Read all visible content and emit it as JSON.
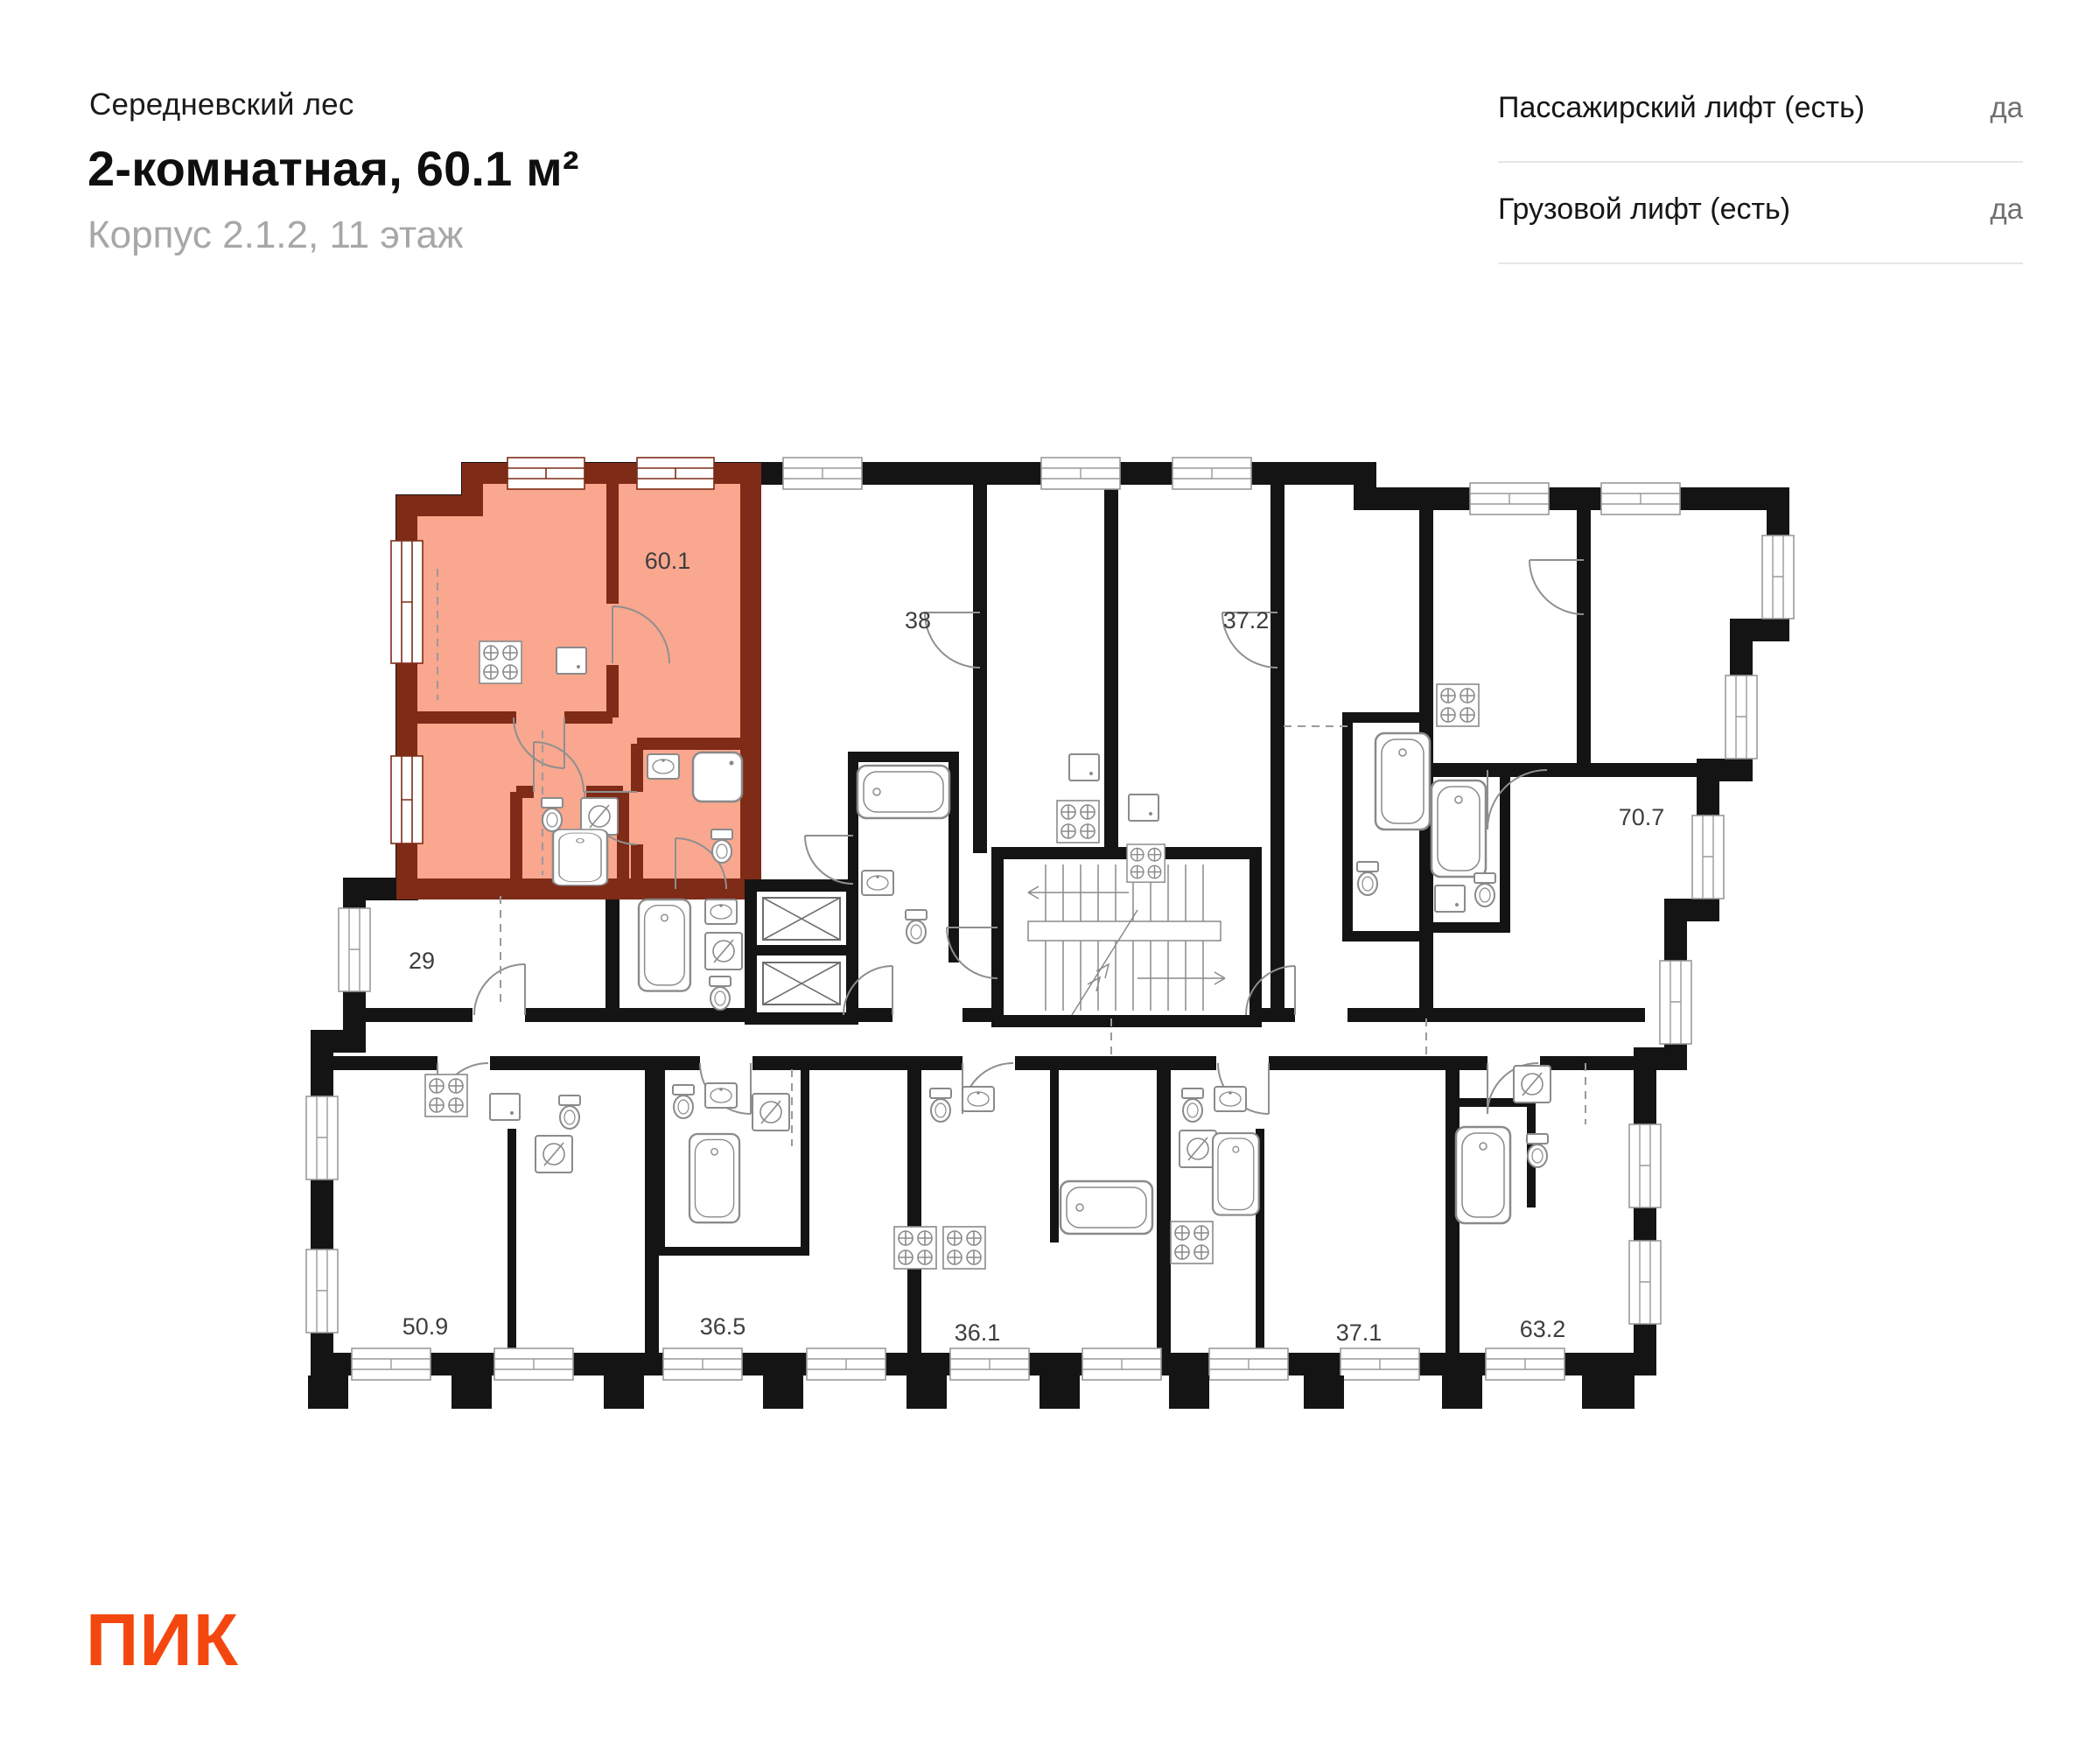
{
  "header": {
    "project": "Середневский лес",
    "title": "2-комнатная, 60.1 м²",
    "subtitle": "Корпус 2.1.2, 11 этаж"
  },
  "info_panel": {
    "rows": [
      {
        "label": "Пассажирский лифт (есть)",
        "value": "да"
      },
      {
        "label": "Грузовой лифт (есть)",
        "value": "да"
      }
    ]
  },
  "logo": {
    "text": "ПИК",
    "color": "#F4470F"
  },
  "floor_plan": {
    "highlighted_unit": {
      "area_label": "60.1",
      "fill": "#F9A78F",
      "wall_color": "#7E2B17"
    },
    "unit_labels": {
      "u38": "38",
      "u37_2": "37.2",
      "u70_7": "70.7",
      "u29": "29",
      "u50_9": "50.9",
      "u36_5": "36.5",
      "u36_1": "36.1",
      "u37_1": "37.1",
      "u63_2": "63.2"
    },
    "colors": {
      "wall": "#141414",
      "fixture_line": "#8a8a8a",
      "label_text": "#3e3e3e",
      "dash_line": "#9a9a9a"
    },
    "fixture_icons": [
      "bathtub-icon",
      "toilet-icon",
      "sink-icon",
      "stove-icon",
      "shower-icon",
      "washing-machine-icon",
      "elevator-shaft-icon",
      "staircase-icon",
      "door-swing-icon",
      "window-icon"
    ]
  }
}
